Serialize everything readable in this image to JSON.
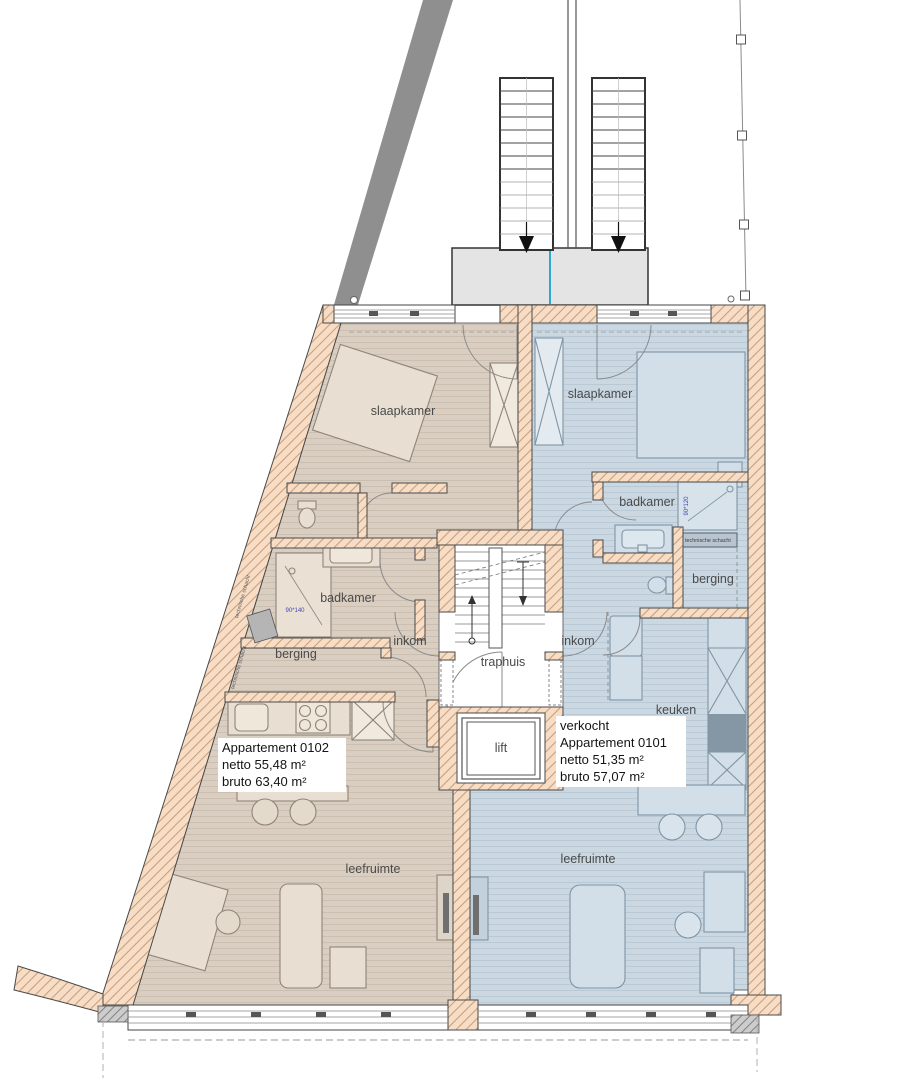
{
  "plan": {
    "apartments": {
      "left": {
        "title": "Appartement 0102",
        "netto": "netto 55,48 m²",
        "bruto": "bruto 63,40 m²"
      },
      "right": {
        "status": "verkocht",
        "title": "Appartement 0101",
        "netto": "netto 51,35 m²",
        "bruto": "bruto 57,07 m²"
      }
    },
    "rooms": {
      "slaapkamer_left": "slaapkamer",
      "slaapkamer_right": "slaapkamer",
      "badkamer_left": "badkamer",
      "badkamer_right": "badkamer",
      "berging_left": "berging",
      "berging_right": "berging",
      "inkom_left": "inkom",
      "inkom_right": "inkom",
      "traphuis": "traphuis",
      "lift": "lift",
      "keuken": "keuken",
      "leefruimte_left": "leefruimte",
      "leefruimte_right": "leefruimte",
      "technische_schacht_box": "technische schacht",
      "schacht_wall_upper": "technische schacht",
      "schacht_wall_lower": "technische schacht"
    },
    "dimensions": {
      "shower_left": "90*140",
      "shower_right": "90*120"
    },
    "colors": {
      "wall_fill": "#f7ddc5",
      "wall_hatch": "#c99e79",
      "floor_left": "#d9cec1",
      "floor_right": "#cbd8e2",
      "accent_blue": "#2ea8cc",
      "ramp_gray": "#8f8f8f"
    }
  }
}
